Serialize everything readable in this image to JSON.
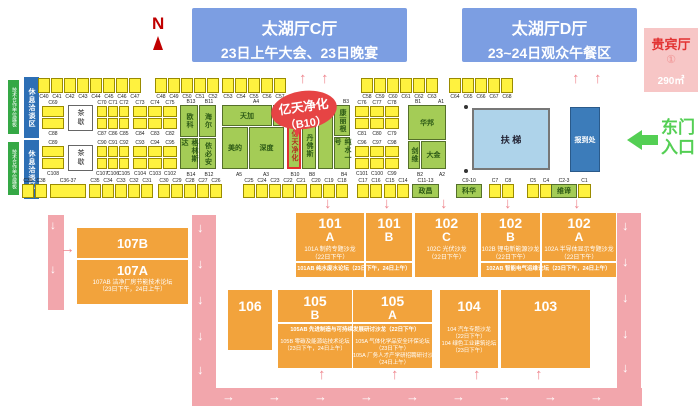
{
  "compass": {
    "letter": "N"
  },
  "halls": {
    "c": {
      "title": "太湖厅C厅",
      "subtitle": "23日上午大会、23日晚宴"
    },
    "d": {
      "title": "太湖厅D厅",
      "subtitle": "23~24日观众午餐区"
    }
  },
  "vip": {
    "title": "贵宾厅",
    "num": "①",
    "area": "290㎡"
  },
  "entrance": {
    "line1": "东门",
    "line2": "入口"
  },
  "escalator": "扶 梯",
  "registration": "报到处",
  "tea_label": "茶歇",
  "strips": {
    "green": "技术合作单位展板",
    "blue": "休息洽谈区"
  },
  "callout": {
    "name": "亿天净化",
    "id": "（B10）"
  },
  "top_booth_rows": [
    {
      "x": 38,
      "labels": [
        "C40",
        "C41",
        "C42",
        "C43",
        "C44",
        "C45",
        "C46",
        "C47"
      ]
    },
    {
      "x": 155,
      "labels": [
        "C48",
        "C49",
        "C50",
        "C51",
        "C52"
      ]
    },
    {
      "x": 222,
      "labels": [
        "C53",
        "C54",
        "C55",
        "C56",
        "C57"
      ]
    },
    {
      "x": 361,
      "labels": [
        "C58",
        "C59",
        "C60",
        "C61",
        "C62",
        "C63"
      ]
    },
    {
      "x": 449,
      "labels": [
        "C64",
        "C65",
        "C66",
        "C67",
        "C68"
      ]
    }
  ],
  "left_sections": [
    {
      "y": 100,
      "col": {
        "top": "C69",
        "bottom": "C88"
      },
      "groups": [
        {
          "x": 97,
          "pitch": 11,
          "w": 10,
          "top": [
            "C70",
            "C71",
            "C72"
          ],
          "bottom": [
            "C87",
            "C86",
            "C85"
          ]
        },
        {
          "x": 133,
          "pitch": 15,
          "w": 14,
          "top": [
            "C73",
            "C74",
            "C75"
          ],
          "bottom": [
            "C84",
            "C83",
            "C82"
          ]
        },
        {
          "x": 355,
          "pitch": 15,
          "w": 14,
          "top": [
            "C76",
            "C77",
            "C78"
          ],
          "bottom": [
            "C81",
            "C80",
            "C79"
          ]
        }
      ]
    },
    {
      "y": 140,
      "col": {
        "top": "C89",
        "bottom": "C108"
      },
      "groups": [
        {
          "x": 97,
          "pitch": 11,
          "w": 10,
          "top": [
            "C90",
            "C91",
            "C92"
          ],
          "bottom": [
            "C107",
            "C106",
            "C105"
          ]
        },
        {
          "x": 133,
          "pitch": 15,
          "w": 14,
          "top": [
            "C93",
            "C94",
            "C95"
          ],
          "bottom": [
            "C104",
            "C103",
            "C102"
          ]
        },
        {
          "x": 355,
          "pitch": 15,
          "w": 14,
          "top": [
            "C96",
            "C97",
            "C98"
          ],
          "bottom": [
            "C101",
            "C100",
            "C99"
          ]
        }
      ]
    }
  ],
  "green_booths": [
    {
      "n": "欧科",
      "x": 180,
      "y": 105,
      "w": 18,
      "h": 32,
      "v": 1
    },
    {
      "n": "海尔",
      "x": 199,
      "y": 105,
      "w": 17,
      "h": 32,
      "v": 1
    },
    {
      "n": "格林斯达",
      "x": 180,
      "y": 138,
      "w": 18,
      "h": 31,
      "v": 1
    },
    {
      "n": "依必安",
      "x": 199,
      "y": 138,
      "w": 17,
      "h": 31,
      "v": 1
    },
    {
      "n": "天加",
      "x": 222,
      "y": 105,
      "w": 50,
      "h": 21
    },
    {
      "n": "",
      "x": 273,
      "y": 105,
      "w": 11,
      "h": 21
    },
    {
      "n": "美的",
      "x": 222,
      "y": 127,
      "w": 26,
      "h": 42
    },
    {
      "n": "深度",
      "x": 249,
      "y": 127,
      "w": 35,
      "h": 42
    },
    {
      "n": "",
      "x": 287,
      "y": 105,
      "w": 14,
      "h": 16
    },
    {
      "n": "亿天净化",
      "x": 287,
      "y": 122,
      "w": 14,
      "h": 47,
      "v": 1,
      "hl": 1
    },
    {
      "n": "",
      "x": 302,
      "y": 105,
      "w": 14,
      "h": 16
    },
    {
      "n": "丹佛斯",
      "x": 302,
      "y": 122,
      "w": 14,
      "h": 47,
      "v": 1
    },
    {
      "n": "",
      "x": 318,
      "y": 105,
      "w": 15,
      "h": 64
    },
    {
      "n": "康丽根",
      "x": 334,
      "y": 105,
      "w": 16,
      "h": 31,
      "v": 1
    },
    {
      "n": "纯水一号",
      "x": 334,
      "y": 137,
      "w": 16,
      "h": 32,
      "v": 1
    },
    {
      "n": "华邦",
      "x": 408,
      "y": 105,
      "w": 38,
      "h": 35
    },
    {
      "n": "剑维",
      "x": 408,
      "y": 141,
      "w": 12,
      "h": 28,
      "v": 1
    },
    {
      "n": "大金",
      "x": 421,
      "y": 141,
      "w": 25,
      "h": 28
    }
  ],
  "green_zone_labels": {
    "top": [
      {
        "t": "B13",
        "x": 183
      },
      {
        "t": "B11",
        "x": 201
      },
      {
        "t": "A4",
        "x": 248
      },
      {
        "t": "B3",
        "x": 338
      },
      {
        "t": "B1",
        "x": 410
      },
      {
        "t": "A1",
        "x": 433
      }
    ],
    "bottom": [
      {
        "t": "B14",
        "x": 183
      },
      {
        "t": "B12",
        "x": 201
      },
      {
        "t": "A5",
        "x": 231
      },
      {
        "t": "A3",
        "x": 258
      },
      {
        "t": "B10",
        "x": 287
      },
      {
        "t": "B8",
        "x": 304
      },
      {
        "t": "B4",
        "x": 336
      },
      {
        "t": "B2",
        "x": 412
      },
      {
        "t": "A2",
        "x": 434
      }
    ]
  },
  "bottom_row": [
    {
      "x": 22,
      "items": [
        {
          "label": "C39"
        },
        {
          "label": "C38"
        }
      ]
    },
    {
      "x": 50,
      "items": [
        {
          "label": "C36-37",
          "w": 36
        }
      ]
    },
    {
      "x": 89,
      "items": [
        {
          "label": "C35"
        },
        {
          "label": "C34"
        },
        {
          "label": "C33"
        },
        {
          "label": "C32"
        },
        {
          "label": "C31"
        }
      ]
    },
    {
      "x": 158,
      "items": [
        {
          "label": "C30"
        },
        {
          "label": "C29"
        },
        {
          "label": "C28"
        },
        {
          "label": "C27"
        },
        {
          "label": "C26"
        }
      ]
    },
    {
      "x": 243,
      "items": [
        {
          "label": "C25"
        },
        {
          "label": "C24"
        },
        {
          "label": "C23"
        },
        {
          "label": "C22"
        },
        {
          "label": "C21"
        }
      ]
    },
    {
      "x": 310,
      "items": [
        {
          "label": "C20"
        },
        {
          "label": "C19"
        },
        {
          "label": "C18"
        }
      ]
    },
    {
      "x": 357,
      "items": [
        {
          "label": "C17"
        },
        {
          "label": "C16"
        }
      ]
    },
    {
      "x": 384,
      "items": [
        {
          "label": "C15"
        },
        {
          "label": "C14"
        }
      ]
    },
    {
      "x": 412,
      "items": [
        {
          "label": "C11-13",
          "name": "政昌",
          "w": 27
        }
      ]
    },
    {
      "x": 456,
      "items": [
        {
          "label": "C9-10",
          "name": "科华",
          "w": 26
        }
      ]
    },
    {
      "x": 489,
      "items": [
        {
          "label": "C7"
        },
        {
          "label": "C8"
        }
      ]
    },
    {
      "x": 527,
      "items": [
        {
          "label": "C5"
        },
        {
          "label": "C4"
        }
      ]
    },
    {
      "x": 551,
      "items": [
        {
          "label": "C2-3",
          "name": "维谛",
          "w": 26
        }
      ]
    },
    {
      "x": 578,
      "items": [
        {
          "label": "C1",
          "w": 13
        }
      ]
    }
  ],
  "forums": {
    "row1": [
      {
        "num": "101",
        "letter": "A",
        "x": 296,
        "w": 68,
        "subtitle": [
          "101A 制药专题沙龙",
          "（22日下午）"
        ]
      },
      {
        "num": "101",
        "letter": "B",
        "x": 366,
        "w": 46,
        "subtitle": []
      },
      {
        "num": "102",
        "letter": "C",
        "x": 415,
        "w": 63,
        "subtitle": [
          "102C 光伏沙龙",
          "（22日下午）"
        ]
      },
      {
        "num": "102",
        "letter": "B",
        "x": 481,
        "w": 59,
        "subtitle": [
          "102B 锂电新能源沙龙",
          "（22日下午）"
        ]
      },
      {
        "num": "102",
        "letter": "A",
        "x": 542,
        "w": 74,
        "subtitle": [
          "102A 半导体显示专题沙龙",
          "（22日下午）"
        ]
      }
    ],
    "row1_bands": [
      {
        "x": 296,
        "w": 116,
        "text": "101AB 纯水废水论坛（23日下午，24日上午）"
      },
      {
        "x": 481,
        "w": 135,
        "text": "102AB 智能电气运维论坛（23日下午，24日上午）"
      }
    ],
    "row2": [
      {
        "num": "106",
        "x": 228,
        "w": 44,
        "h": 60,
        "subtitle": []
      },
      {
        "num": "105",
        "letter": "B",
        "x": 278,
        "w": 74,
        "h": 78,
        "subtitle": [
          "105B 零碳及能源站技术论坛",
          "（23日下午，24日上午）"
        ]
      },
      {
        "num": "105",
        "letter": "A",
        "x": 353,
        "w": 79,
        "h": 78,
        "subtitle": [
          "105A 气体化学品安全环保论坛",
          "（23日下午）",
          "105A 厂务人才产学研招聘研讨沙龙",
          "（24日上午）"
        ]
      },
      {
        "num": "104",
        "x": 440,
        "w": 58,
        "h": 78,
        "subtitle": [
          "104 汽车专题沙龙",
          "（22日下午）",
          "104 绿色工业建筑论坛",
          "（23日下午）"
        ]
      },
      {
        "num": "103",
        "x": 501,
        "w": 89,
        "h": 78,
        "subtitle": []
      }
    ],
    "row2_band": {
      "x": 278,
      "w": 154,
      "text": "105AB 先进制造与可持续发展研讨沙龙（22日下午）"
    },
    "blk107": {
      "top": "107B",
      "bottom": "107A",
      "subtitle": [
        "107AB 洁净厂房节能技术论坛",
        "（23日下午，24日上午）"
      ]
    }
  }
}
